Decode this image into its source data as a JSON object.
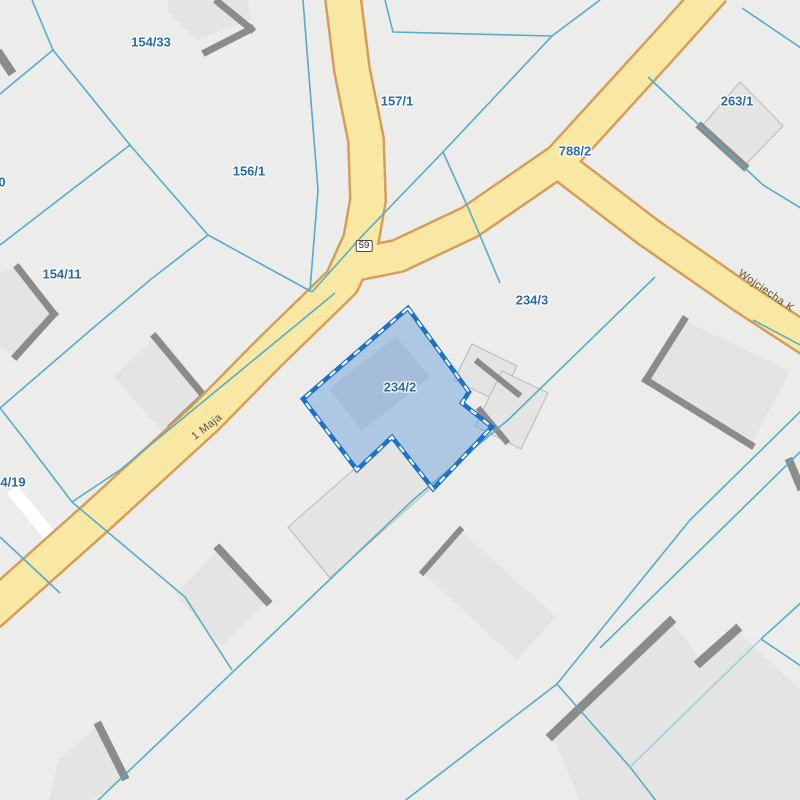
{
  "map": {
    "type": "cadastral-parcel-map",
    "colors": {
      "background": "#ecedeb",
      "boundary": "#55abc9",
      "boundary_light": "#9dd0e0",
      "road_fill": "#f9e8a4",
      "road_casing": "#d69d58",
      "building_fill": "#e4e4e2",
      "building_outline": "#b9b9b7",
      "building_shadow": "#8b8b89",
      "selection_fill": "#6fa3dc",
      "selection_stroke": "#1b72c8",
      "selection_dash": "#ffffff",
      "parcel_label_color": "#2a6ba3",
      "street_label_color": "#55544a",
      "white_path": "#ffffff"
    },
    "selected_parcel": {
      "id": "234/2",
      "polygon": [
        [
          408,
          308
        ],
        [
          469,
          392
        ],
        [
          462,
          403
        ],
        [
          492,
          427
        ],
        [
          433,
          489
        ],
        [
          392,
          437
        ],
        [
          357,
          470
        ],
        [
          303,
          399
        ]
      ]
    },
    "parcel_labels": [
      {
        "text": "154/33",
        "x": 151,
        "y": 42
      },
      {
        "text": "157/1",
        "x": 397,
        "y": 101
      },
      {
        "text": "156/1",
        "x": 249,
        "y": 171
      },
      {
        "text": "154/11",
        "x": 62,
        "y": 274
      },
      {
        "text": "0",
        "x": 2,
        "y": 182
      },
      {
        "text": "4/19",
        "x": 13,
        "y": 482
      },
      {
        "text": "788/2",
        "x": 575,
        "y": 151
      },
      {
        "text": "263/1",
        "x": 737,
        "y": 101
      },
      {
        "text": "234/3",
        "x": 532,
        "y": 300
      },
      {
        "text": "234/2",
        "x": 400,
        "y": 387
      }
    ],
    "street_labels": [
      {
        "text": "1 Maja",
        "x": 207,
        "y": 427,
        "angle": -38
      },
      {
        "text": "Wojciecha K",
        "x": 766,
        "y": 291,
        "angle": 35
      }
    ],
    "route_badge": {
      "text": "59",
      "x": 364,
      "y": 246
    },
    "roads": [
      {
        "name": "route-59-north",
        "w": 33,
        "points": [
          [
            342,
            -10
          ],
          [
            352,
            70
          ],
          [
            366,
            140
          ],
          [
            368,
            200
          ],
          [
            361,
            240
          ],
          [
            342,
            282
          ],
          [
            270,
            352
          ],
          [
            205,
            418
          ],
          [
            98,
            516
          ],
          [
            -12,
            614
          ]
        ]
      },
      {
        "name": "road-788-2",
        "w": 30,
        "points": [
          [
            714,
            -10
          ],
          [
            662,
            48
          ],
          [
            560,
            160
          ],
          [
            470,
            222
          ],
          [
            398,
            256
          ],
          [
            358,
            264
          ]
        ]
      },
      {
        "name": "wojciecha",
        "w": 28,
        "points": [
          [
            558,
            163
          ],
          [
            648,
            232
          ],
          [
            740,
            296
          ],
          [
            812,
            343
          ]
        ]
      }
    ],
    "white_path": {
      "points": [
        [
          12,
          489
        ],
        [
          66,
          556
        ]
      ],
      "w": 13
    },
    "boundaries": [
      {
        "points": [
          [
            32,
            0
          ],
          [
            53,
            50
          ],
          [
            130,
            145
          ],
          [
            208,
            235
          ],
          [
            312,
            292
          ]
        ]
      },
      {
        "points": [
          [
            53,
            50
          ],
          [
            0,
            94
          ]
        ]
      },
      {
        "points": [
          [
            130,
            145
          ],
          [
            0,
            245
          ]
        ]
      },
      {
        "points": [
          [
            208,
            235
          ],
          [
            150,
            280
          ],
          [
            93,
            328
          ],
          [
            0,
            408
          ]
        ]
      },
      {
        "points": [
          [
            0,
            408
          ],
          [
            25,
            440
          ],
          [
            72,
            502
          ]
        ]
      },
      {
        "points": [
          [
            72,
            502
          ],
          [
            120,
            470
          ],
          [
            335,
            293
          ]
        ]
      },
      {
        "points": [
          [
            72,
            502
          ],
          [
            185,
            597
          ],
          [
            232,
            670
          ]
        ]
      },
      {
        "points": [
          [
            0,
            537
          ],
          [
            60,
            593
          ]
        ]
      },
      {
        "points": [
          [
            303,
            0
          ],
          [
            318,
            190
          ],
          [
            310,
            290
          ]
        ]
      },
      {
        "points": [
          [
            385,
            0
          ],
          [
            393,
            32
          ],
          [
            552,
            36
          ]
        ]
      },
      {
        "points": [
          [
            600,
            0
          ],
          [
            552,
            36
          ],
          [
            443,
            152
          ],
          [
            363,
            235
          ],
          [
            312,
            292
          ]
        ]
      },
      {
        "points": [
          [
            443,
            152
          ],
          [
            470,
            212
          ],
          [
            500,
            283
          ]
        ]
      },
      {
        "points": [
          [
            655,
            277
          ],
          [
            508,
            420
          ],
          [
            497,
            429
          ],
          [
            413,
            500
          ],
          [
            300,
            608
          ],
          [
            92,
            806
          ]
        ]
      },
      {
        "points": [
          [
            753,
            320
          ],
          [
            804,
            347
          ]
        ]
      },
      {
        "points": [
          [
            804,
            408
          ],
          [
            690,
            520
          ],
          [
            557,
            684
          ]
        ]
      },
      {
        "points": [
          [
            800,
            452
          ],
          [
            690,
            560
          ],
          [
            600,
            648
          ]
        ]
      },
      {
        "points": [
          [
            557,
            684
          ],
          [
            630,
            767
          ],
          [
            660,
            806
          ]
        ]
      },
      {
        "points": [
          [
            557,
            684
          ],
          [
            398,
            806
          ]
        ]
      },
      {
        "points": [
          [
            804,
            600
          ],
          [
            761,
            639
          ],
          [
            804,
            668
          ]
        ]
      },
      {
        "points": [
          [
            761,
            639
          ],
          [
            630,
            767
          ]
        ],
        "light": true
      },
      {
        "points": [
          [
            648,
            77
          ],
          [
            763,
            185
          ],
          [
            804,
            210
          ]
        ]
      },
      {
        "points": [
          [
            742,
            8
          ],
          [
            804,
            50
          ]
        ]
      }
    ],
    "buildings": [
      {
        "pts": [
          [
            168,
            0
          ],
          [
            248,
            0
          ],
          [
            250,
            20
          ],
          [
            196,
            40
          ],
          [
            168,
            12
          ]
        ]
      },
      {
        "pts": [
          [
            0,
            272
          ],
          [
            18,
            268
          ],
          [
            54,
            314
          ],
          [
            16,
            356
          ],
          [
            0,
            348
          ]
        ]
      },
      {
        "pts": [
          [
            155,
            337
          ],
          [
            204,
            396
          ],
          [
            164,
            434
          ],
          [
            114,
            376
          ]
        ]
      },
      {
        "pts": [
          [
            740,
            82
          ],
          [
            783,
            126
          ],
          [
            744,
            166
          ],
          [
            701,
            127
          ]
        ],
        "outline": true
      },
      {
        "pts": [
          [
            684,
            320
          ],
          [
            790,
            371
          ],
          [
            751,
            445
          ],
          [
            646,
            380
          ]
        ]
      },
      {
        "pts": [
          [
            472,
            344
          ],
          [
            517,
            366
          ],
          [
            499,
            402
          ],
          [
            454,
            380
          ]
        ],
        "outline": true
      },
      {
        "pts": [
          [
            502,
            371
          ],
          [
            548,
            393
          ],
          [
            521,
            449
          ],
          [
            475,
            426
          ]
        ],
        "outline": true
      },
      {
        "pts": [
          [
            391,
            437
          ],
          [
            432,
            487
          ],
          [
            330,
            578
          ],
          [
            288,
            527
          ]
        ],
        "outline": true
      },
      {
        "pts": [
          [
            460,
            530
          ],
          [
            556,
            617
          ],
          [
            517,
            660
          ],
          [
            422,
            572
          ]
        ]
      },
      {
        "pts": [
          [
            552,
            735
          ],
          [
            670,
            622
          ],
          [
            688,
            641
          ],
          [
            700,
            662
          ],
          [
            736,
            630
          ],
          [
            800,
            689
          ],
          [
            806,
            700
          ],
          [
            806,
            806
          ],
          [
            582,
            806
          ]
        ]
      },
      {
        "pts": [
          [
            219,
            549
          ],
          [
            267,
            601
          ],
          [
            222,
            646
          ],
          [
            175,
            594
          ]
        ]
      },
      {
        "pts": [
          [
            58,
            760
          ],
          [
            98,
            726
          ],
          [
            126,
            778
          ],
          [
            82,
            806
          ],
          [
            48,
            806
          ]
        ]
      },
      {
        "pts": [
          [
            396,
            336
          ],
          [
            430,
            377
          ],
          [
            362,
            431
          ],
          [
            329,
            389
          ]
        ],
        "fill": "#d9d9d7"
      }
    ],
    "shadow_bands": [
      {
        "pts": [
          [
            218,
            2
          ],
          [
            251,
            29
          ]
        ]
      },
      {
        "pts": [
          [
            251,
            29
          ],
          [
            206,
            52
          ]
        ]
      },
      {
        "pts": [
          [
            0,
            55
          ],
          [
            10,
            70
          ]
        ],
        "w": 9
      },
      {
        "pts": [
          [
            18,
            268
          ],
          [
            54,
            314
          ]
        ]
      },
      {
        "pts": [
          [
            54,
            314
          ],
          [
            16,
            356
          ]
        ]
      },
      {
        "pts": [
          [
            155,
            337
          ],
          [
            204,
            396
          ]
        ]
      },
      {
        "pts": [
          [
            204,
            396
          ],
          [
            172,
            426
          ]
        ]
      },
      {
        "pts": [
          [
            701,
            127
          ],
          [
            744,
            166
          ]
        ],
        "w": 8
      },
      {
        "pts": [
          [
            684,
            320
          ],
          [
            646,
            380
          ]
        ]
      },
      {
        "pts": [
          [
            646,
            380
          ],
          [
            751,
            445
          ]
        ]
      },
      {
        "pts": [
          [
            478,
            362
          ],
          [
            518,
            394
          ]
        ],
        "w": 6
      },
      {
        "pts": [
          [
            480,
            410
          ],
          [
            506,
            441
          ]
        ],
        "w": 6
      },
      {
        "pts": [
          [
            423,
            572
          ],
          [
            460,
            530
          ]
        ],
        "w": 6
      },
      {
        "pts": [
          [
            552,
            735
          ],
          [
            670,
            622
          ]
        ],
        "w": 9
      },
      {
        "pts": [
          [
            700,
            662
          ],
          [
            736,
            630
          ]
        ],
        "w": 9
      },
      {
        "pts": [
          [
            219,
            549
          ],
          [
            267,
            601
          ]
        ],
        "w": 8
      },
      {
        "pts": [
          [
            99,
            726
          ],
          [
            124,
            776
          ]
        ],
        "w": 8
      },
      {
        "pts": [
          [
            790,
            462
          ],
          [
            800,
            486
          ]
        ],
        "w": 8
      }
    ]
  }
}
